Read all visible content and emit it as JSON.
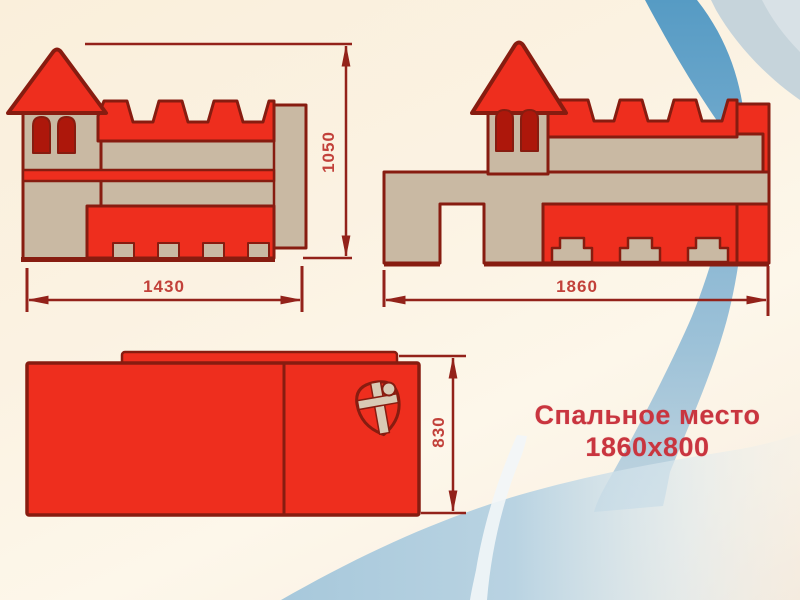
{
  "product_label": {
    "line1": "Спальное место",
    "line2": "1860x800"
  },
  "dimensions": {
    "side_left_width": "1430",
    "side_left_height": "1050",
    "side_right_width": "1860",
    "top_view_depth": "830"
  },
  "icons": {
    "shield_crest": "shield-crest-icon",
    "tower_windows": "arched-window-icon",
    "ribbons": "blue-ribbon-decoration"
  },
  "colors": {
    "castle_red": "#ee2e1e",
    "castle_tan": "#c9b9a3",
    "outline_maroon": "#871c10",
    "window_red": "#ad170b",
    "dimension_line": "#93221a",
    "dimension_text": "#c2413a",
    "label_text": "#c9353f",
    "background_cream": "#fbf2e2",
    "ribbon_blue": "#5f9fc7",
    "ribbon_pale_blue": "#b5cfe0",
    "corner_wash_blue": "#c6d4db"
  }
}
